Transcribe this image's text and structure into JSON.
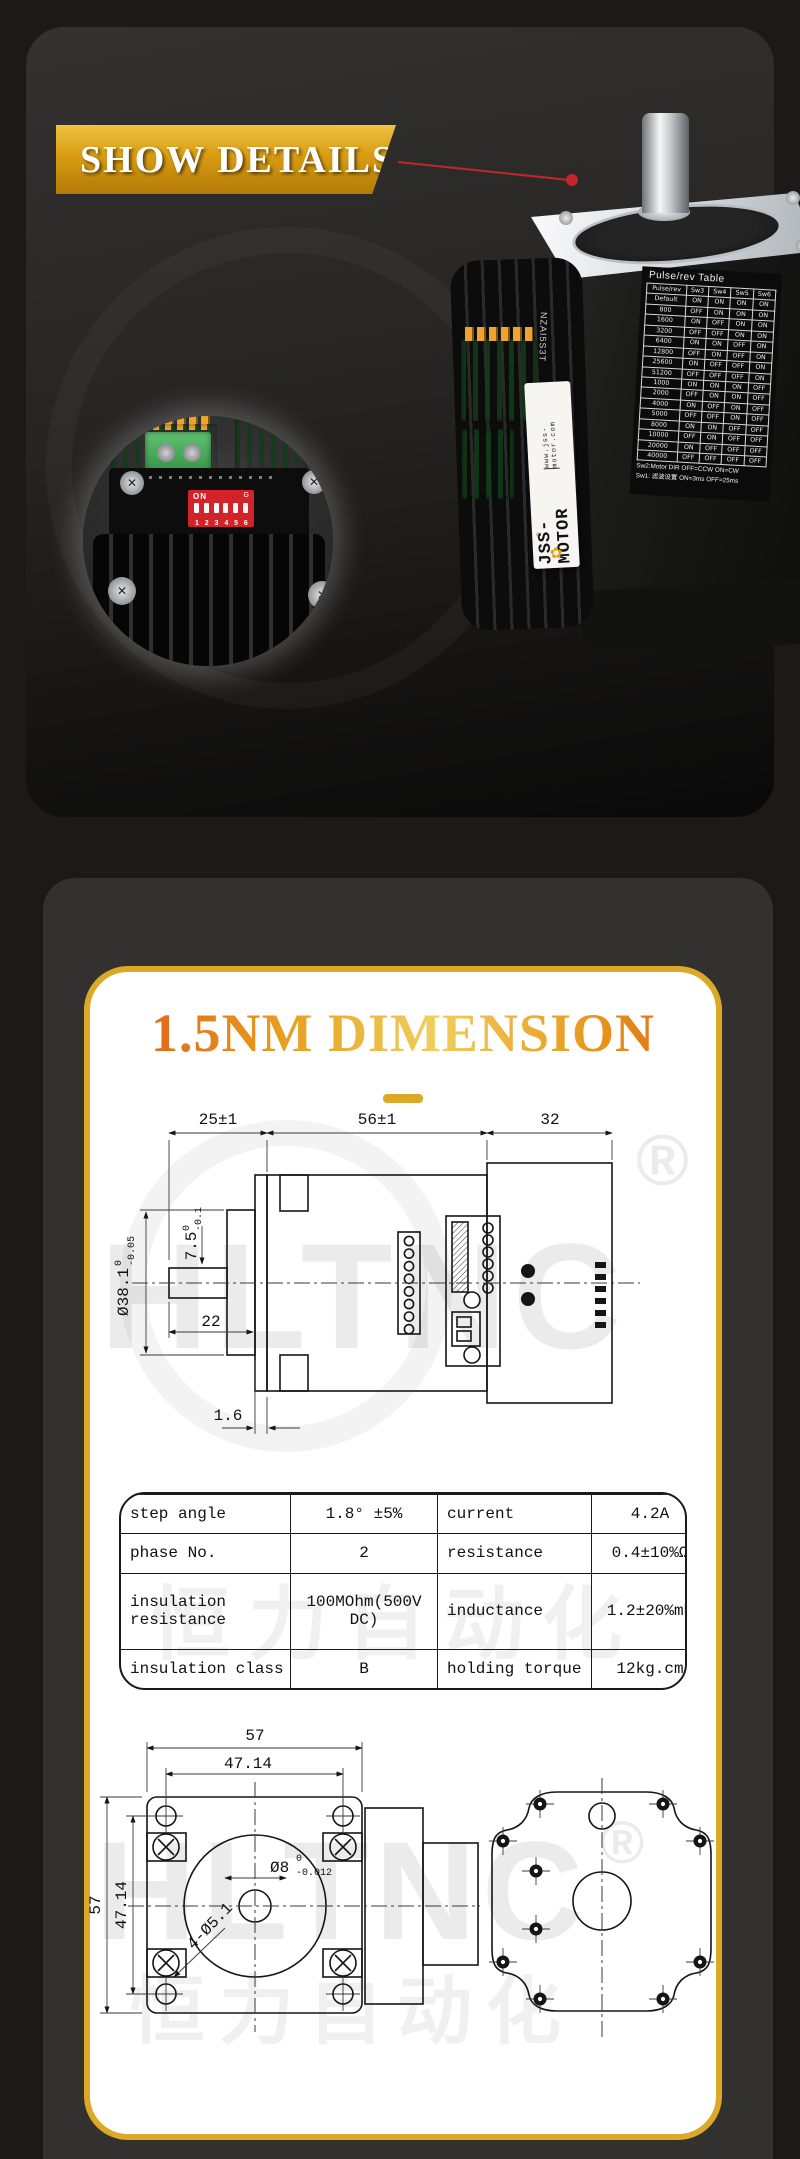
{
  "banner": {
    "label": "SHOW DETAILS"
  },
  "motor": {
    "emboss": "NZAI5S3T",
    "label": {
      "brand": "JSS-MOTOR",
      "url": "www.jss-motor.com",
      "flower": "✿",
      "registered": "®"
    },
    "pulse_table": {
      "title": "Pulse/rev Table",
      "columns": [
        "Pulse/rev",
        "Sw3",
        "Sw4",
        "Sw5",
        "Sw6"
      ],
      "rows": [
        [
          "Default",
          "ON",
          "ON",
          "ON",
          "ON"
        ],
        [
          "800",
          "OFF",
          "ON",
          "ON",
          "ON"
        ],
        [
          "1600",
          "ON",
          "OFF",
          "ON",
          "ON"
        ],
        [
          "3200",
          "OFF",
          "OFF",
          "ON",
          "ON"
        ],
        [
          "6400",
          "ON",
          "ON",
          "OFF",
          "ON"
        ],
        [
          "12800",
          "OFF",
          "ON",
          "OFF",
          "ON"
        ],
        [
          "25600",
          "ON",
          "OFF",
          "OFF",
          "ON"
        ],
        [
          "51200",
          "OFF",
          "OFF",
          "OFF",
          "ON"
        ],
        [
          "1000",
          "ON",
          "ON",
          "ON",
          "OFF"
        ],
        [
          "2000",
          "OFF",
          "ON",
          "ON",
          "OFF"
        ],
        [
          "4000",
          "ON",
          "OFF",
          "ON",
          "OFF"
        ],
        [
          "5000",
          "OFF",
          "OFF",
          "ON",
          "OFF"
        ],
        [
          "8000",
          "ON",
          "ON",
          "OFF",
          "OFF"
        ],
        [
          "10000",
          "OFF",
          "ON",
          "OFF",
          "OFF"
        ],
        [
          "20000",
          "ON",
          "OFF",
          "OFF",
          "OFF"
        ],
        [
          "40000",
          "OFF",
          "OFF",
          "OFF",
          "OFF"
        ]
      ],
      "footnote1": "Sw2:Motor DIR OFF=CCW ON=CW",
      "footnote2": "Sw1: 滤波设置 ON=3ms OFF=25ms"
    }
  },
  "inset": {
    "dip": {
      "on_label": "ON",
      "brand_mark": "G",
      "numbers": [
        "1",
        "2",
        "3",
        "4",
        "5",
        "6"
      ]
    }
  },
  "section": {
    "title": "1.5NM DIMENSION"
  },
  "watermark": {
    "brand": "HLTNC",
    "registered": "®",
    "cn": "恒力自动化"
  },
  "side_view": {
    "len_front": "25±1",
    "len_body": "56±1",
    "len_driver": "32",
    "shaft_len": "22",
    "gap": "1.6",
    "boss_len": {
      "v": "7.5",
      "sup": "0",
      "sub": "-0.1"
    },
    "boss_dia": {
      "v": "Ø38.1",
      "sup": "0",
      "sub": "-0.05"
    }
  },
  "front_view": {
    "width": "57",
    "hole_span_top": "47.14",
    "height": "57",
    "hole_span_side": "47.14",
    "shaft_dia": {
      "v": "Ø8",
      "sup": "0",
      "sub": "-0.012"
    },
    "holes": "4-Ø5.1"
  },
  "spec_table": {
    "rows": [
      [
        "step angle",
        "1.8° ±5%",
        "current",
        "4.2A"
      ],
      [
        "phase No.",
        "2",
        "resistance",
        "0.4±10%Ω"
      ],
      [
        "insulation resistance",
        "100MOhm(500V DC)",
        "inductance",
        "1.2±20%mH"
      ],
      [
        "insulation class",
        "B",
        "holding torque",
        "12kg.cm"
      ]
    ]
  }
}
